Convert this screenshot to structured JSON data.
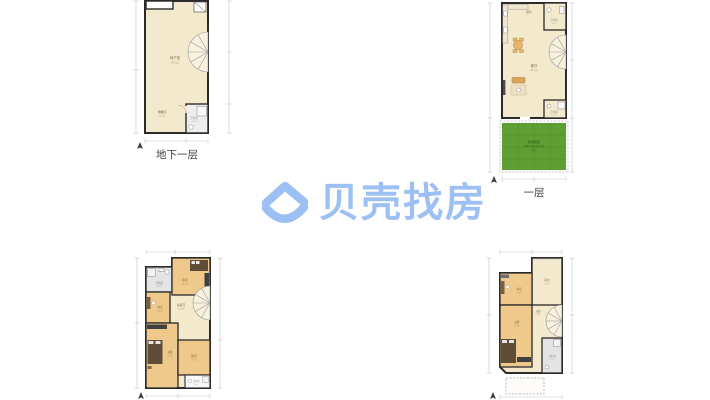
{
  "watermark": {
    "brand": "贝壳找房",
    "color": "#9cc0f3"
  },
  "palette": {
    "wall": "#2a2a2a",
    "floor": "#f3e9cd",
    "warm_room": "#efc98b",
    "gray_room": "#e4e4e4",
    "garden": "#5f9e33",
    "dim_line": "#c4c4c4",
    "label": "#3f3f3f"
  },
  "plans": {
    "basement": {
      "label": "地下一层",
      "rooms": {
        "main": "地下室",
        "main_area": "57.0㎡",
        "storage": "储藏间",
        "storage_area": "11.4㎡",
        "bath": "卫生间",
        "bath_area": "5.3㎡"
      }
    },
    "first": {
      "label": "一层",
      "rooms": {
        "kitchen": "厨房",
        "bath_top": "卫生间",
        "bath_top_area": "4.2㎡",
        "living": "客厅",
        "living_area": "40.1㎡",
        "bath_bottom": "卫生间",
        "bath_bottom_area": "3.6㎡",
        "garden_line1": "私家花园",
        "garden_line2": "具体以实际交付为准",
        "garden_area": "35㎡"
      }
    },
    "second": {
      "rooms": {
        "bath_top": "卫生间",
        "bath_top_area": "4.6㎡",
        "bed_top": "卧室",
        "bed_top_area": "10.7㎡",
        "study": "书房",
        "study_area": "6.5㎡",
        "hall": "家庭厅",
        "hall_area": "10.2㎡",
        "master": "主卧",
        "master_area": "15.6㎡",
        "bed_bottom": "卧室",
        "bed_bottom_area": "9.1㎡",
        "bath_bottom": "卫生间",
        "bath_bottom_area": "3.2㎡"
      }
    },
    "third": {
      "rooms": {
        "study": "书房",
        "study_area": "8.4㎡",
        "terrace": "露台",
        "terrace_area": "9.6㎡",
        "master": "主卧",
        "master_area": "13.8㎡",
        "hall": "过道",
        "hall_area": "2.4㎡",
        "bath": "卫生间",
        "bath_area": "5.1㎡"
      }
    }
  }
}
